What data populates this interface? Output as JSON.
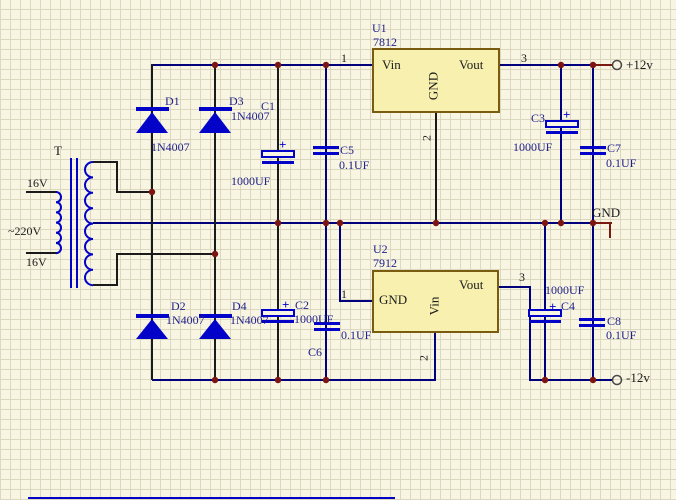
{
  "schematic": {
    "transformer": {
      "ref": "T",
      "primary_label": "~220V",
      "secondary_top_label": "16V",
      "secondary_bottom_label": "16V"
    },
    "diodes": [
      {
        "ref": "D1",
        "part": "1N4007"
      },
      {
        "ref": "D2",
        "part": "1N4007"
      },
      {
        "ref": "D3",
        "part": "1N4007"
      },
      {
        "ref": "D4",
        "part": "1N4007"
      }
    ],
    "capacitors": [
      {
        "ref": "C1",
        "value": "1000UF",
        "polarized": true
      },
      {
        "ref": "C2",
        "value": "1000UF",
        "polarized": true
      },
      {
        "ref": "C3",
        "value": "1000UF",
        "polarized": true
      },
      {
        "ref": "C4",
        "value": "1000UF",
        "polarized": true
      },
      {
        "ref": "C5",
        "value": "0.1UF",
        "polarized": false
      },
      {
        "ref": "C6",
        "value": "0.1UF",
        "polarized": false
      },
      {
        "ref": "C7",
        "value": "0.1UF",
        "polarized": false
      },
      {
        "ref": "C8",
        "value": "0.1UF",
        "polarized": false
      }
    ],
    "regulators": [
      {
        "ref": "U1",
        "part": "7812",
        "pin_left": "Vin",
        "pin_middle": "GND",
        "pin_right": "Vout",
        "pin_numbers": [
          "1",
          "2",
          "3"
        ]
      },
      {
        "ref": "U2",
        "part": "7912",
        "pin_left": "GND",
        "pin_middle": "Vin",
        "pin_right": "Vout",
        "pin_numbers": [
          "1",
          "2",
          "3"
        ]
      }
    ],
    "outputs": {
      "positive": "+12v",
      "ground": "GND",
      "negative": "-12v"
    },
    "symbols": {
      "plus": "+"
    }
  },
  "colors": {
    "wire_blue": "#00007d",
    "wire_black": "#1a1a1a",
    "component_blue": "#0202c8",
    "junction_red": "#7c1412",
    "box_fill": "#f7f0ae",
    "box_border": "#7a5c10",
    "background": "#f8f5e3",
    "grid_line": "#dcd8c0"
  }
}
